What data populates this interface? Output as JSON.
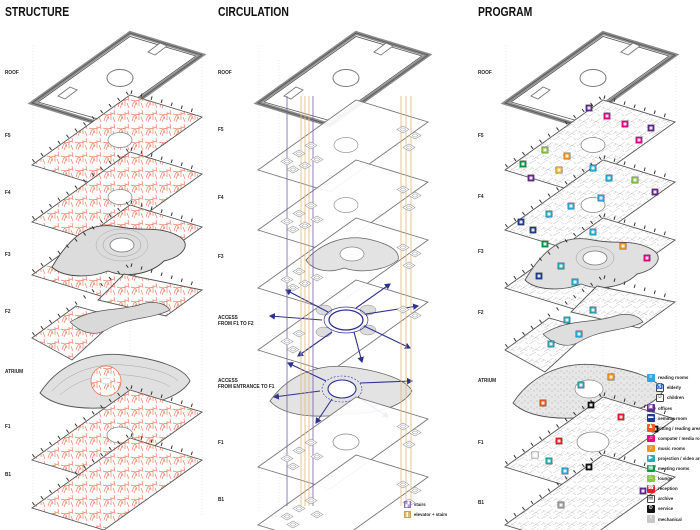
{
  "titles": {
    "structure": "STRUCTURE",
    "circulation": "CIRCULATION",
    "program": "PROGRAM"
  },
  "floors": {
    "structure": [
      "ROOF",
      "F5",
      "F4",
      "F3",
      "F2",
      "ATRIUM",
      "F1",
      "B1"
    ],
    "circulation": [
      "ROOF",
      "F5",
      "F4",
      "F3",
      "F1",
      "B1"
    ],
    "program": [
      "ROOF",
      "F5",
      "F4",
      "F3",
      "F2",
      "ATRIUM",
      "F1",
      "B1"
    ]
  },
  "annotations": {
    "access1_line1": "ACCESS",
    "access1_line2": "FROM F1 TO F2",
    "access2_line1": "ACCESS",
    "access2_line2": "FROM ENTRANCE TO F1"
  },
  "circulation_legend": {
    "items": [
      {
        "label": "stairs",
        "color": "#B9A1CE",
        "icon": "stairs-icon",
        "glyph": "▞"
      },
      {
        "label": "elevator + stairs",
        "color": "#E2B878",
        "icon": "elevator-stairs-icon",
        "glyph": ""
      }
    ]
  },
  "legend": {
    "items": [
      {
        "label": "reading rooms",
        "color": "#29ABE2",
        "glyph": "≡",
        "icon": "book-icon"
      },
      {
        "label": "elderly",
        "color": "#FFFFFF",
        "glyph": "♿",
        "icon": "wheelchair-icon",
        "indent": true
      },
      {
        "label": "children",
        "color": "#FFFFFF",
        "glyph": "☺",
        "icon": "child-icon",
        "indent": true
      },
      {
        "label": "offices",
        "color": "#662D91",
        "glyph": "▣",
        "icon": "desk-icon"
      },
      {
        "label": "seminar room",
        "color": "#1C3F94",
        "glyph": "▬",
        "icon": "lectern-icon"
      },
      {
        "label": "sitting / reading area",
        "color": "#F15A24",
        "glyph": "♟",
        "icon": "person-icon"
      },
      {
        "label": "computer / media room",
        "color": "#EC008C",
        "glyph": "♫",
        "icon": "headphones-icon"
      },
      {
        "label": "music rooms",
        "color": "#F7941E",
        "glyph": "♪",
        "icon": "note-icon"
      },
      {
        "label": "projection / video area",
        "color": "#2AA9B8",
        "glyph": "▶",
        "icon": "projector-icon"
      },
      {
        "label": "meeting rooms",
        "color": "#009E49",
        "glyph": "▦",
        "icon": "table-icon"
      },
      {
        "label": "lounge",
        "color": "#8CC63F",
        "glyph": "♨",
        "icon": "sofa-icon"
      },
      {
        "label": "reception",
        "color": "#ED1C24",
        "glyph": "☎",
        "icon": "phone-icon"
      },
      {
        "label": "archive",
        "color": "#FFFFFF",
        "glyph": "▤",
        "icon": "box-icon"
      },
      {
        "label": "service",
        "color": "#111111",
        "glyph": "⚙",
        "icon": "gear-icon"
      },
      {
        "label": "mechanical",
        "color": "#C8C8C8",
        "glyph": "×",
        "icon": "fan-icon"
      }
    ]
  },
  "colors": {
    "structure_hatch": "#ED8063",
    "circulation_stair_line": "#7A5FA8",
    "circulation_elevator_line": "#E2B878",
    "circulation_arrow": "#2E3192",
    "plate_outline": "#666666"
  }
}
